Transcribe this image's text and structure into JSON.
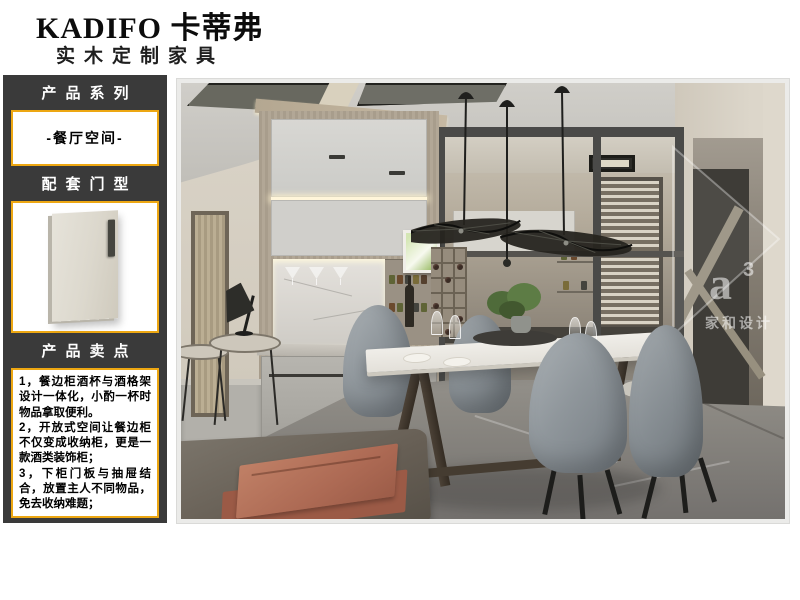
{
  "brand": {
    "name": "KADIFO 卡蒂弗",
    "tagline": "实木定制家具"
  },
  "sidebar": {
    "series_title": "产品系列",
    "series_value": "-餐厅空间-",
    "door_title": "配套门型",
    "selling_title": "产品卖点",
    "selling_points": [
      "1，餐边柜酒杯与酒格架设计一体化，小酌一杯时物品拿取便利。",
      "2，开放式空间让餐边柜不仅变成收纳柜，更是一款酒类装饰柜；",
      "3，下柜门板与抽屉结合，放置主人不同物品，免去收纳难题；"
    ]
  },
  "photo": {
    "description": "餐厅空间效果图",
    "watermark_logo": "a",
    "watermark_sup": "3",
    "watermark_name": "家和设计"
  },
  "colors": {
    "accent_gold": "#eda712",
    "panel_dark": "#3a3a3a",
    "terracotta": "#ad6a54"
  }
}
